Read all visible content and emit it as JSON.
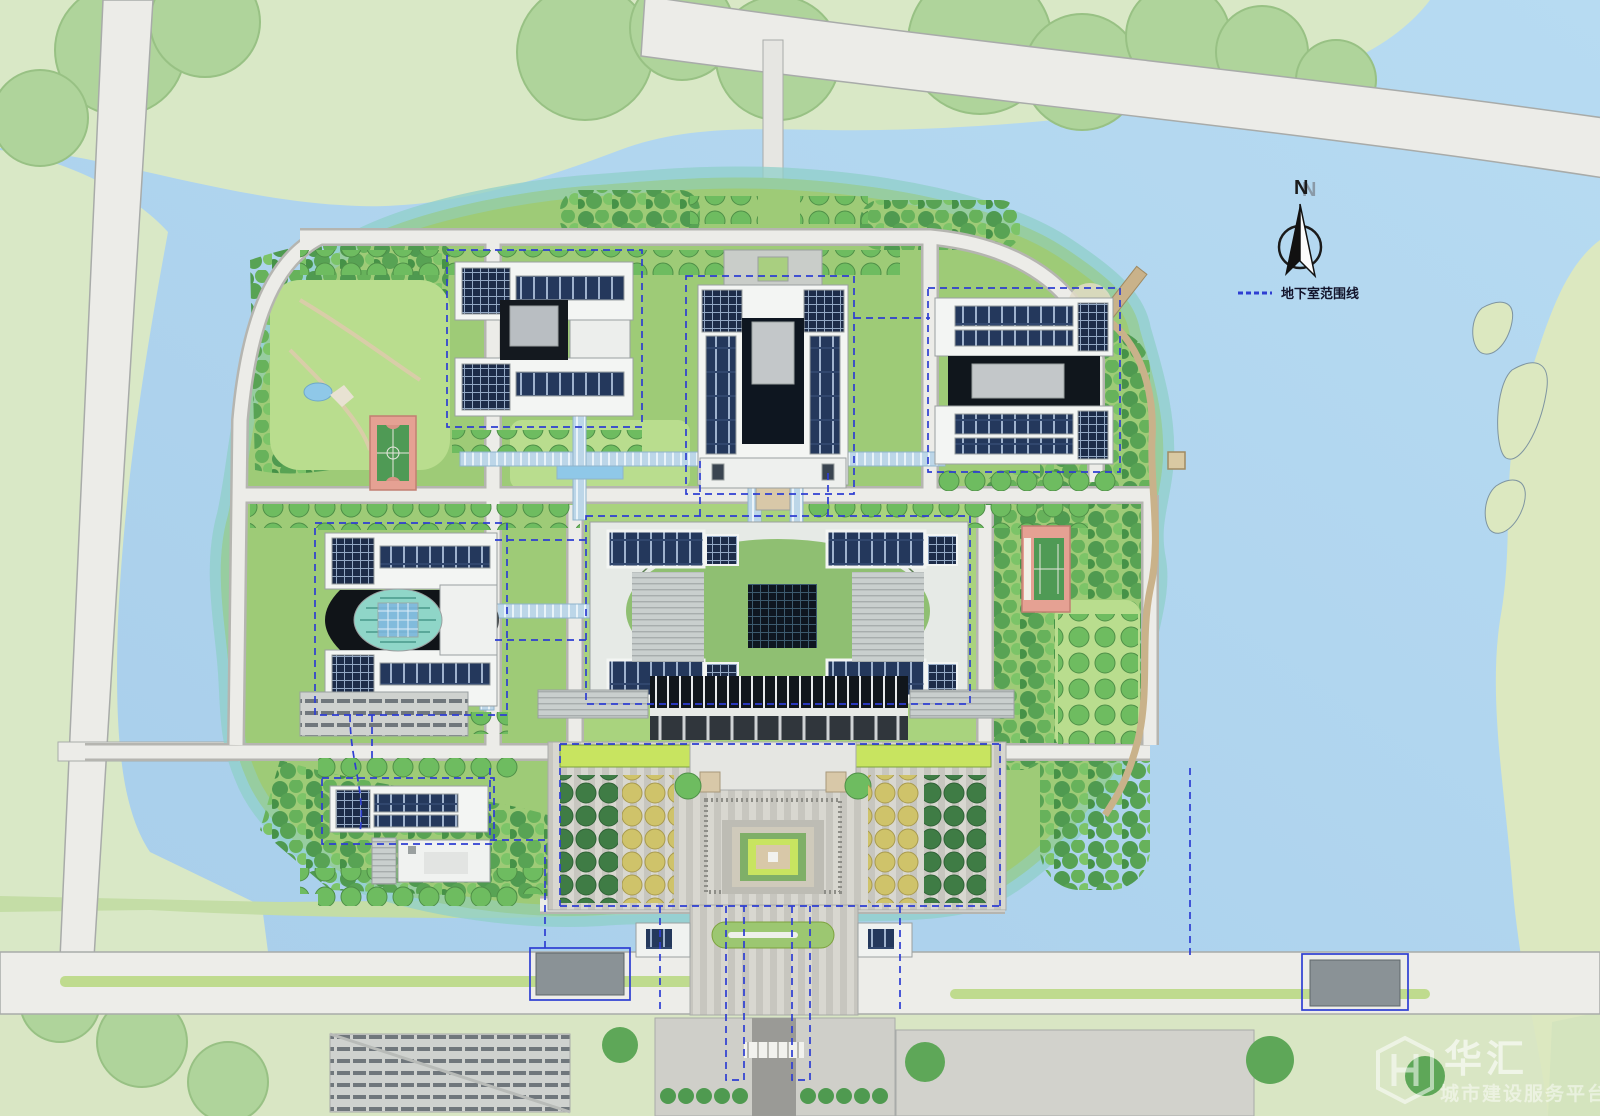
{
  "map": {
    "kind": "architectural-site-plan",
    "description": "campus master plan on an island surrounded by water"
  },
  "compass": {
    "label": "N"
  },
  "legend": {
    "items": [
      {
        "symbol": "blue-dashed-line",
        "label": "地下室范围线"
      }
    ]
  },
  "watermark": {
    "brand": "华汇",
    "tagline": "城市建设服务平台",
    "logo": "hh-hexagon-logo"
  },
  "palette": {
    "water": "#9cc3e6",
    "water_light": "#b7dbf2",
    "water_shallow": "#8fd0c9",
    "land_pale": "#d9e8c6",
    "canopy": "#afd49b",
    "forest_dark": "#4f9a50",
    "lawn": "#9ecb77",
    "lawn_light": "#b9dd8e",
    "road": "#ececE8",
    "road_edge": "#a8aba9",
    "building_white": "#f3f5f3",
    "solar_panel": "#24385c",
    "glass_dark": "#0e1620",
    "glass_walkway": "#bcd6e8",
    "court_pink": "#e5a193",
    "court_green": "#4f9a55",
    "plaza_paving": "#d8d7d0",
    "basement_line": "#2e3ed2",
    "tree_dark": "#3f7c45",
    "tree_yellow": "#cfc36a"
  }
}
